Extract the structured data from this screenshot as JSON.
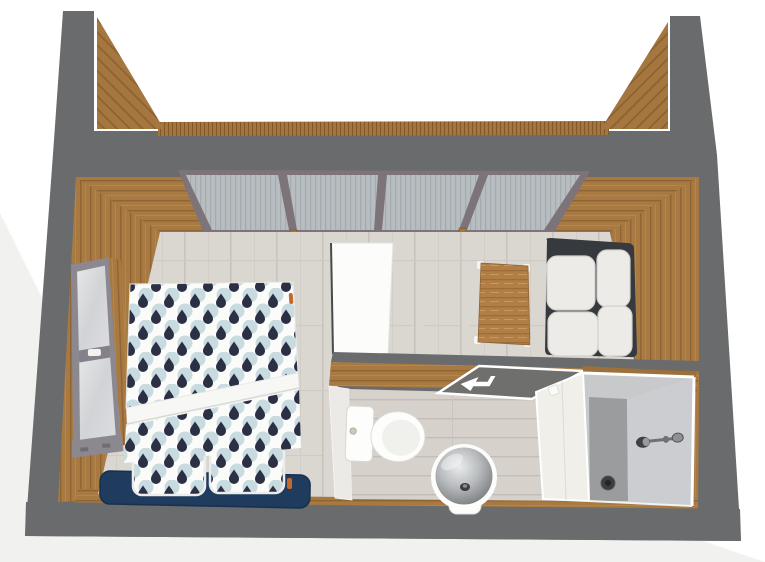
{
  "scene": {
    "type": "3d-dollhouse-floorplan-render",
    "room_label": "bedroom-with-ensuite-bathroom",
    "objects": [
      {
        "name": "glass-wall",
        "label": "four-pane glass wall"
      },
      {
        "name": "window",
        "label": "two-pane window in left wall"
      },
      {
        "name": "double-bed",
        "label": "double bed, patterned duvet, two pillows, navy headboard"
      },
      {
        "name": "white-cabinet",
        "label": "white cabinet"
      },
      {
        "name": "coffee-table",
        "label": "wooden coffee table with white feet"
      },
      {
        "name": "sofa",
        "label": "two-seat sofa, white cushions, dark frame"
      },
      {
        "name": "toilet",
        "label": "toilet with cistern"
      },
      {
        "name": "washbasin",
        "label": "round glass washbasin"
      },
      {
        "name": "door-mat",
        "label": "gray mat with white entry arrow"
      },
      {
        "name": "shower",
        "label": "walk-in shower with wall-mounted shower head and floor drain"
      }
    ]
  },
  "palette": {
    "wall_gray": "#6a6b6c",
    "wood": "#a87a42",
    "wood_dark": "#8f6434",
    "wood_light": "#b78c51",
    "floor_base": "#dad6d0",
    "floor_line": "#c8c4bd",
    "glass_pane": "#b7bdc0",
    "glass_frame": "#7c7478",
    "window_frame": "#8b8890",
    "window_glass": "#d9dadc",
    "duvet_white": "#fbfbfa",
    "pattern_blue": "#bcd3da",
    "pattern_navy": "#2c3045",
    "headboard_navy": "#1f3c5e",
    "fold_white": "#f7f7f5",
    "sofa_frame": "#36393d",
    "cushion_white": "#ecebe8",
    "cabinet_white": "#fcfcfb",
    "table_wood": "#b17f46",
    "bath_floor": "#d6d2cb",
    "bath_wall_white": "#eceae7",
    "mat_gray": "#6f706e",
    "fixture_white": "#fdfdfc",
    "basin_glass": "#9b9da0",
    "shower_back": "#c7c9cb",
    "shower_side": "#cbcdd0",
    "shower_floor": "#9a9c9e",
    "shower_door": "#f1efe9",
    "drain_dark": "#3c3d3f",
    "chrome": "#6f7174",
    "accent_orange": "#c4692e",
    "bg_shadow": "#f1f1f0"
  }
}
